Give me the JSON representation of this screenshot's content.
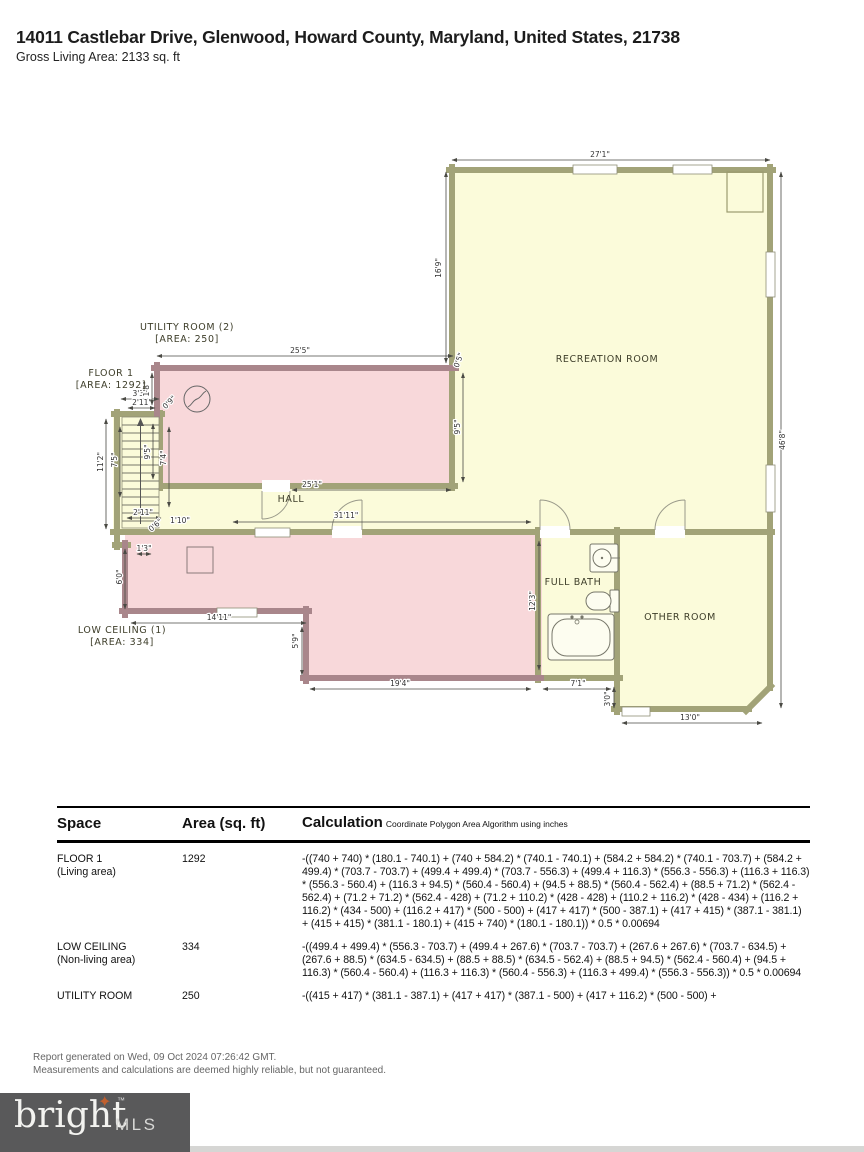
{
  "header": {
    "address": "14011 Castlebar Drive, Glenwood, Howard County, Maryland, United States, 21738",
    "gross_living_area": "Gross Living Area: 2133 sq. ft"
  },
  "plan": {
    "colors": {
      "living_fill": "#fbfbda",
      "living_wall": "#a2a378",
      "nonliving_fill": "#f8d8da",
      "nonliving_wall": "#a9868b"
    },
    "room_labels": [
      {
        "name": "utility-room",
        "text": "UTILITY ROOM (2)",
        "text2": "[AREA: 250]",
        "x": 187,
        "y": 330
      },
      {
        "name": "floor-1",
        "text": "FLOOR 1",
        "text2": "[AREA: 1292]",
        "x": 111,
        "y": 376
      },
      {
        "name": "recreation-room",
        "text": "RECREATION ROOM",
        "x": 607,
        "y": 362
      },
      {
        "name": "hall",
        "text": "HALL",
        "x": 291,
        "y": 502
      },
      {
        "name": "low-ceiling",
        "text": "LOW CEILING (1)",
        "text2": "[AREA: 334]",
        "x": 122,
        "y": 633
      },
      {
        "name": "full-bath",
        "text": "FULL BATH",
        "x": 573,
        "y": 585
      },
      {
        "name": "other-room",
        "text": "OTHER ROOM",
        "x": 680,
        "y": 620
      }
    ],
    "dimensions": [
      {
        "label": "27'1\"",
        "x": 600,
        "y": 157,
        "rot": 0,
        "line": [
          452,
          160,
          770,
          160
        ]
      },
      {
        "label": "16'9\"",
        "x": 441,
        "y": 268,
        "rot": -90,
        "line": [
          446,
          172,
          446,
          363
        ]
      },
      {
        "label": "46'8\"",
        "x": 785,
        "y": 440,
        "rot": -90,
        "line": [
          781,
          172,
          781,
          708
        ]
      },
      {
        "label": "25'5\"",
        "x": 300,
        "y": 353,
        "rot": 0,
        "line": [
          157,
          356,
          453,
          356
        ]
      },
      {
        "label": "0'5\"",
        "x": 461,
        "y": 361,
        "rot": -70
      },
      {
        "label": "9'5\"",
        "x": 460,
        "y": 427,
        "rot": -90,
        "line": [
          463,
          373,
          463,
          482
        ]
      },
      {
        "label": "25'1\"",
        "x": 312,
        "y": 487,
        "rot": 0,
        "line": [
          292,
          490,
          451,
          490
        ]
      },
      {
        "label": "31'11\"",
        "x": 346,
        "y": 518,
        "rot": 0,
        "line": [
          233,
          522,
          531,
          522
        ]
      },
      {
        "label": "3'3\"",
        "x": 140,
        "y": 396,
        "rot": 0,
        "line": [
          121,
          399,
          159,
          399
        ]
      },
      {
        "label": "2'11\"",
        "x": 142,
        "y": 405,
        "rot": 0,
        "line": [
          128,
          408,
          155,
          408
        ]
      },
      {
        "label": "1'8\"",
        "x": 149,
        "y": 389,
        "rot": -90,
        "line": [
          152,
          373,
          152,
          405
        ]
      },
      {
        "label": "0'9\"",
        "x": 171,
        "y": 404,
        "rot": -45
      },
      {
        "label": "11'2\"",
        "x": 103,
        "y": 462,
        "rot": -90,
        "line": [
          106,
          419,
          106,
          529
        ]
      },
      {
        "label": "7'5\"",
        "x": 117,
        "y": 460,
        "rot": -90,
        "line": [
          120,
          427,
          120,
          497
        ]
      },
      {
        "label": "9'5\"",
        "x": 150,
        "y": 452,
        "rot": -90,
        "line": [
          153,
          424,
          153,
          479
        ]
      },
      {
        "label": "7'4\"",
        "x": 166,
        "y": 458,
        "rot": -90,
        "line": [
          169,
          427,
          169,
          507
        ]
      },
      {
        "label": "2'11\"",
        "x": 143,
        "y": 515,
        "rot": 0,
        "line": [
          127,
          518,
          161,
          518
        ]
      },
      {
        "label": "0'6\"",
        "x": 157,
        "y": 527,
        "rot": -40
      },
      {
        "label": "1'10\"",
        "x": 180,
        "y": 523,
        "rot": 0
      },
      {
        "label": "1'3\"",
        "x": 144,
        "y": 551,
        "rot": 0,
        "line": [
          137,
          554,
          151,
          554
        ]
      },
      {
        "label": "6'0\"",
        "x": 122,
        "y": 577,
        "rot": -90,
        "line": [
          125,
          549,
          125,
          609
        ]
      },
      {
        "label": "14'11\"",
        "x": 219,
        "y": 620,
        "rot": 0,
        "line": [
          131,
          623,
          306,
          623
        ]
      },
      {
        "label": "5'9\"",
        "x": 298,
        "y": 641,
        "rot": -90,
        "line": [
          302,
          627,
          302,
          675
        ]
      },
      {
        "label": "19'4\"",
        "x": 400,
        "y": 686,
        "rot": 0,
        "line": [
          310,
          689,
          531,
          689
        ]
      },
      {
        "label": "12'3\"",
        "x": 535,
        "y": 601,
        "rot": -90,
        "line": [
          539,
          541,
          539,
          670
        ]
      },
      {
        "label": "7'1\"",
        "x": 578,
        "y": 686,
        "rot": 0,
        "line": [
          543,
          689,
          611,
          689
        ]
      },
      {
        "label": "3'0\"",
        "x": 610,
        "y": 699,
        "rot": -90,
        "line": [
          614,
          687,
          614,
          708
        ]
      },
      {
        "label": "13'0\"",
        "x": 690,
        "y": 720,
        "rot": 0,
        "line": [
          622,
          723,
          762,
          723
        ]
      }
    ]
  },
  "table": {
    "headers": {
      "space": "Space",
      "area": "Area (sq. ft)",
      "calculation": "Calculation",
      "note": "Coordinate Polygon Area Algorithm using inches"
    },
    "rows": [
      {
        "space": "FLOOR 1",
        "space2": "(Living area)",
        "area": "1292",
        "calc": "-((740 + 740) * (180.1 - 740.1) + (740 + 584.2) * (740.1 - 740.1) + (584.2 + 584.2) * (740.1 - 703.7) + (584.2 + 499.4) * (703.7 - 703.7) + (499.4 + 499.4) * (703.7 - 556.3) + (499.4 + 116.3) * (556.3 - 556.3) + (116.3 + 116.3) * (556.3 - 560.4) + (116.3 + 94.5) * (560.4 - 560.4) + (94.5 + 88.5) * (560.4 - 562.4) + (88.5 + 71.2) * (562.4 - 562.4) + (71.2 + 71.2) * (562.4 - 428) + (71.2 + 110.2) * (428 - 428) + (110.2 + 116.2) * (428 - 434) + (116.2 + 116.2) * (434 - 500) + (116.2 + 417) * (500 - 500) + (417 + 417) * (500 - 387.1) + (417 + 415) * (387.1 - 381.1) + (415 + 415) * (381.1 - 180.1) + (415 + 740) * (180.1 - 180.1)) * 0.5 * 0.00694"
      },
      {
        "space": "LOW CEILING",
        "space2": "(Non-living area)",
        "area": "334",
        "calc": "-((499.4 + 499.4) * (556.3 - 703.7) + (499.4 + 267.6) * (703.7 - 703.7) + (267.6 + 267.6) * (703.7 - 634.5) + (267.6 + 88.5) * (634.5 - 634.5) + (88.5 + 88.5) * (634.5 - 562.4) + (88.5 + 94.5) * (562.4 - 560.4) + (94.5 + 116.3) * (560.4 - 560.4) + (116.3 + 116.3) * (560.4 - 556.3) + (116.3 + 499.4) * (556.3 - 556.3)) * 0.5 * 0.00694"
      },
      {
        "space": "UTILITY ROOM",
        "space2": "",
        "area": "250",
        "calc": "-((415 + 417) * (381.1 - 387.1) + (417 + 417) * (387.1 - 500) + (417 + 116.2) * (500 - 500) +"
      }
    ]
  },
  "footer": {
    "line1": "Report generated on Wed, 09 Oct 2024 07:26:42 GMT.",
    "line2": "Measurements and calculations are deemed highly reliable, but not guaranteed.",
    "logo": {
      "brand": "bright",
      "tm": "™",
      "suffix": "MLS",
      "box_color": "#59595a",
      "star_color": "#c0602f"
    }
  }
}
